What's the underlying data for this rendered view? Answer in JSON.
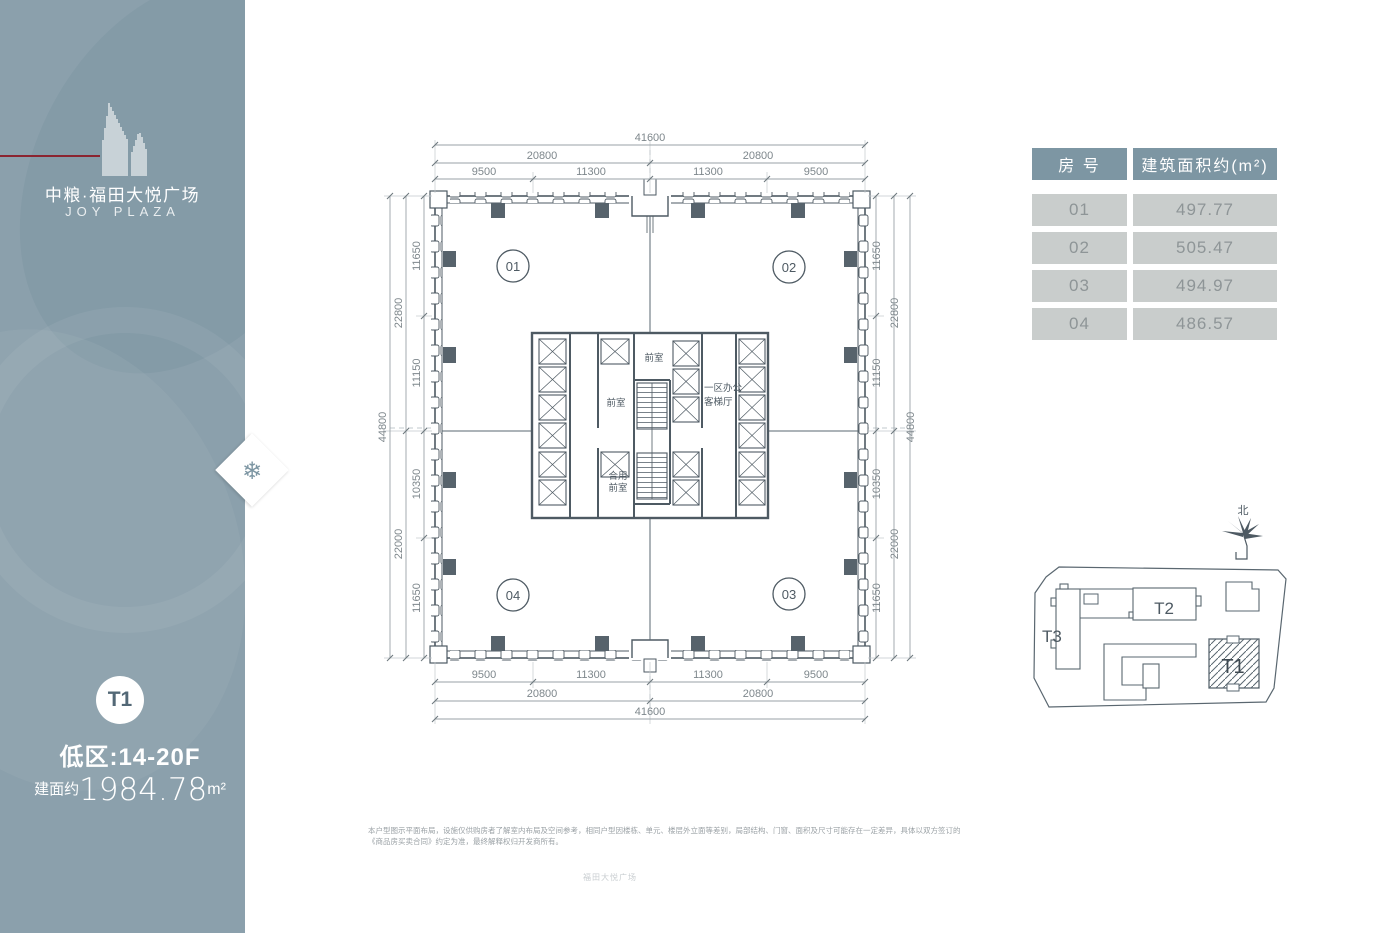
{
  "brand": {
    "name_cn": "中粮·福田大悦广场",
    "name_en": "JOY PLAZA"
  },
  "sidebar": {
    "tower_badge": "T1",
    "zone": "低区:14-20F",
    "area_prefix": "建面约",
    "area_value": "1984.78",
    "area_unit": "m²"
  },
  "area_table": {
    "headers": [
      "房 号",
      "建筑面积约(m²)"
    ],
    "rows": [
      [
        "01",
        "497.77"
      ],
      [
        "02",
        "505.47"
      ],
      [
        "03",
        "494.97"
      ],
      [
        "04",
        "486.57"
      ]
    ]
  },
  "floor_plan": {
    "units": [
      "01",
      "02",
      "03",
      "04"
    ],
    "core_labels": {
      "front_room_top": "前室",
      "front_room_mid": "前室",
      "shared_front_line1": "合用",
      "shared_front_line2": "前室",
      "office_lobby_line1": "一区办公",
      "office_lobby_line2": "客梯厅"
    },
    "dims": {
      "top": {
        "overall": "41600",
        "mid": [
          "20800",
          "20800"
        ],
        "inner": [
          "9500",
          "11300",
          "11300",
          "9500"
        ]
      },
      "bottom": {
        "overall": "41600",
        "mid": [
          "20800",
          "20800"
        ],
        "inner": [
          "9500",
          "11300",
          "11300",
          "9500"
        ]
      },
      "left": {
        "overall": "44800",
        "mid": [
          "22800",
          "22000"
        ],
        "inner": [
          "11650",
          "11150",
          "10350",
          "11650"
        ]
      },
      "right": {
        "overall": "44800",
        "mid": [
          "22800",
          "22000"
        ],
        "inner": [
          "11650",
          "11150",
          "10350",
          "11650"
        ]
      }
    }
  },
  "site_plan": {
    "t1": "T1",
    "t2": "T2",
    "t3": "T3",
    "north_label": "北"
  },
  "disclaimer": "本户型图示平面布局，设施仅供购房者了解室内布局及空间参考，相同户型因楼栋、单元、楼层外立面等差别，局部结构、门窗、面积及尺寸可能存在一定差异，具体以双方签订的《商品房买卖合同》约定为准，最终解释权归开发商所有。",
  "footer_note": "福田大悦广场",
  "colors": {
    "sidebar_bg": "#8BA0AC",
    "accent_red": "#8B2430",
    "plan_line": "#4E5A63",
    "dim_text": "#7E878C",
    "table_header_bg": "#7D96A3",
    "table_cell_bg": "#C9CDCC",
    "table_cell_text": "#8E9597"
  }
}
